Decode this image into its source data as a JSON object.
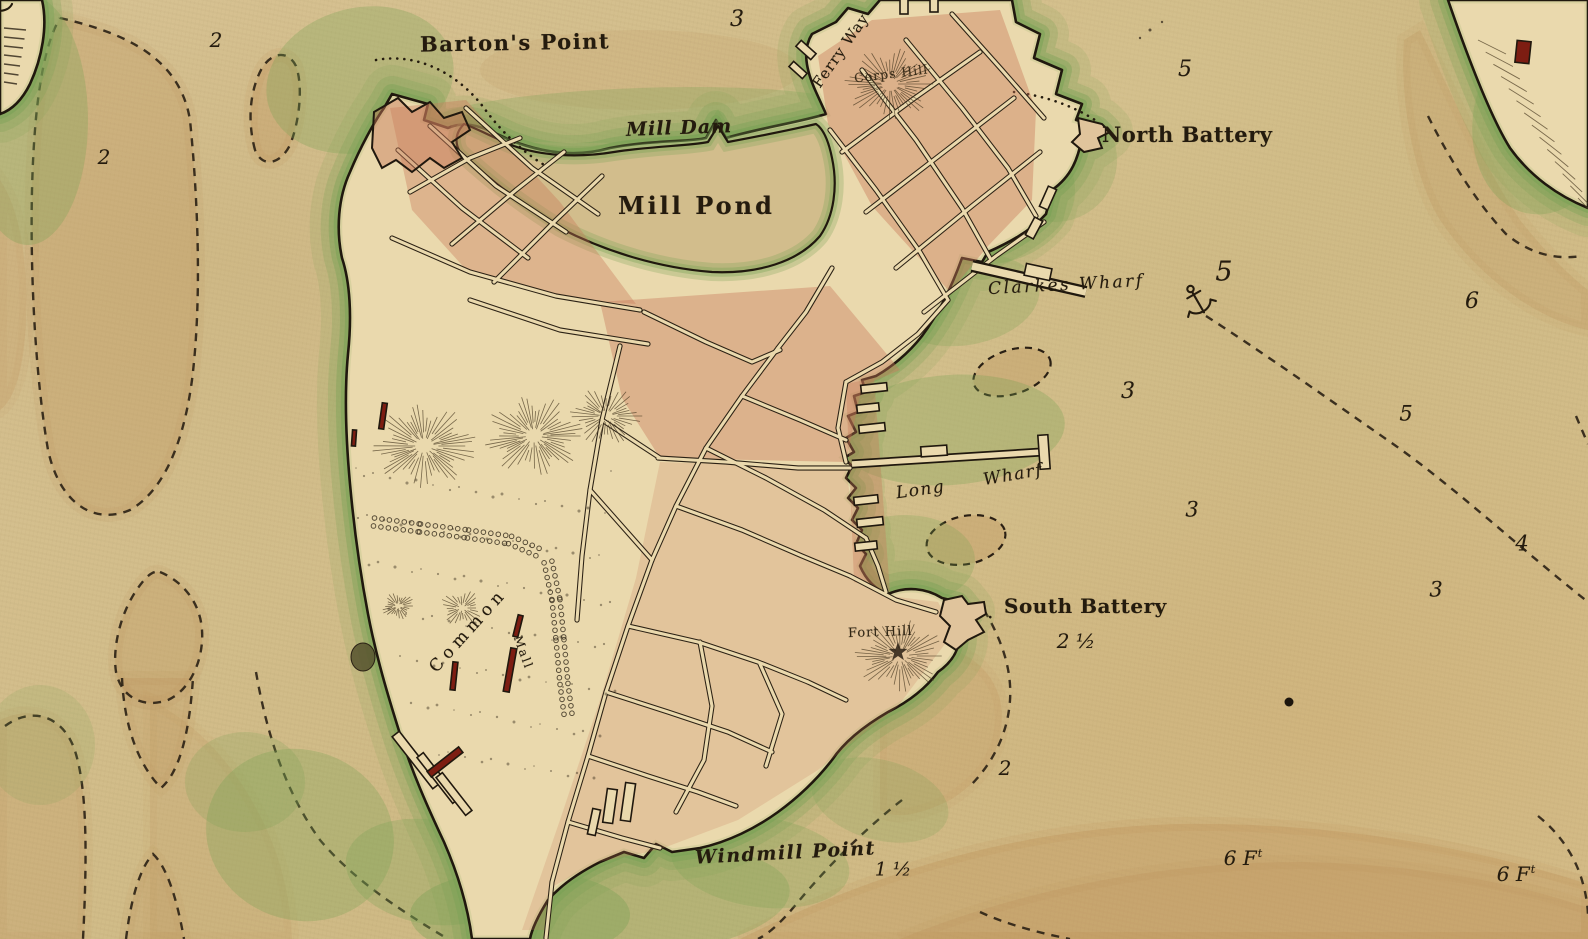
{
  "map": {
    "description": "Hand-drawn colonial harbor chart of the Boston peninsula with wharves, batteries, hills and water-depth soundings",
    "region_labels": {
      "barton_point": "Barton's Point",
      "ferry_way": "Ferry Way",
      "corps_hill": "Corps Hill",
      "north_battery": "North Battery",
      "mill_dam": "Mill Dam",
      "mill_pond": "Mill Pond",
      "clarkes_wharf": "Clarkes Wharf",
      "long_wharf_word1": "Long",
      "long_wharf_word2": "Wharf",
      "south_battery": "South Battery",
      "fort_hill": "Fort Hill",
      "common": "Common",
      "mall": "Mall",
      "windmill_point": "Windmill Point"
    },
    "soundings": [
      {
        "v": "3",
        "x": 737,
        "y": 20,
        "s": 22
      },
      {
        "v": "2",
        "x": 216,
        "y": 40,
        "s": 20
      },
      {
        "v": "2",
        "x": 104,
        "y": 157,
        "s": 20
      },
      {
        "v": "5",
        "x": 1185,
        "y": 70,
        "s": 22
      },
      {
        "v": "5",
        "x": 1224,
        "y": 272,
        "s": 27
      },
      {
        "v": "6",
        "x": 1472,
        "y": 302,
        "s": 22
      },
      {
        "v": "3",
        "x": 1128,
        "y": 392,
        "s": 22
      },
      {
        "v": "5",
        "x": 1406,
        "y": 414,
        "s": 21
      },
      {
        "v": "3",
        "x": 1192,
        "y": 510,
        "s": 21
      },
      {
        "v": "4",
        "x": 1522,
        "y": 544,
        "s": 21
      },
      {
        "v": "3",
        "x": 1436,
        "y": 590,
        "s": 21
      },
      {
        "v": "2 ½",
        "x": 1076,
        "y": 641,
        "s": 20
      },
      {
        "v": "2",
        "x": 1005,
        "y": 768,
        "s": 20
      },
      {
        "v": "1 ½",
        "x": 893,
        "y": 870,
        "s": 19
      },
      {
        "v": "6 F",
        "sup": "t",
        "x": 1243,
        "y": 858,
        "s": 20
      },
      {
        "v": "6 F",
        "sup": "t",
        "x": 1516,
        "y": 874,
        "s": 20
      }
    ],
    "colors": {
      "parchment": "#d5c08e",
      "land": "#ead9ad",
      "shore_green": "#76a153",
      "block_pink": "#c7795a",
      "ink": "#241b0e",
      "shoal_tan": "#bc8e56",
      "building_red": "#7d1d12"
    }
  }
}
